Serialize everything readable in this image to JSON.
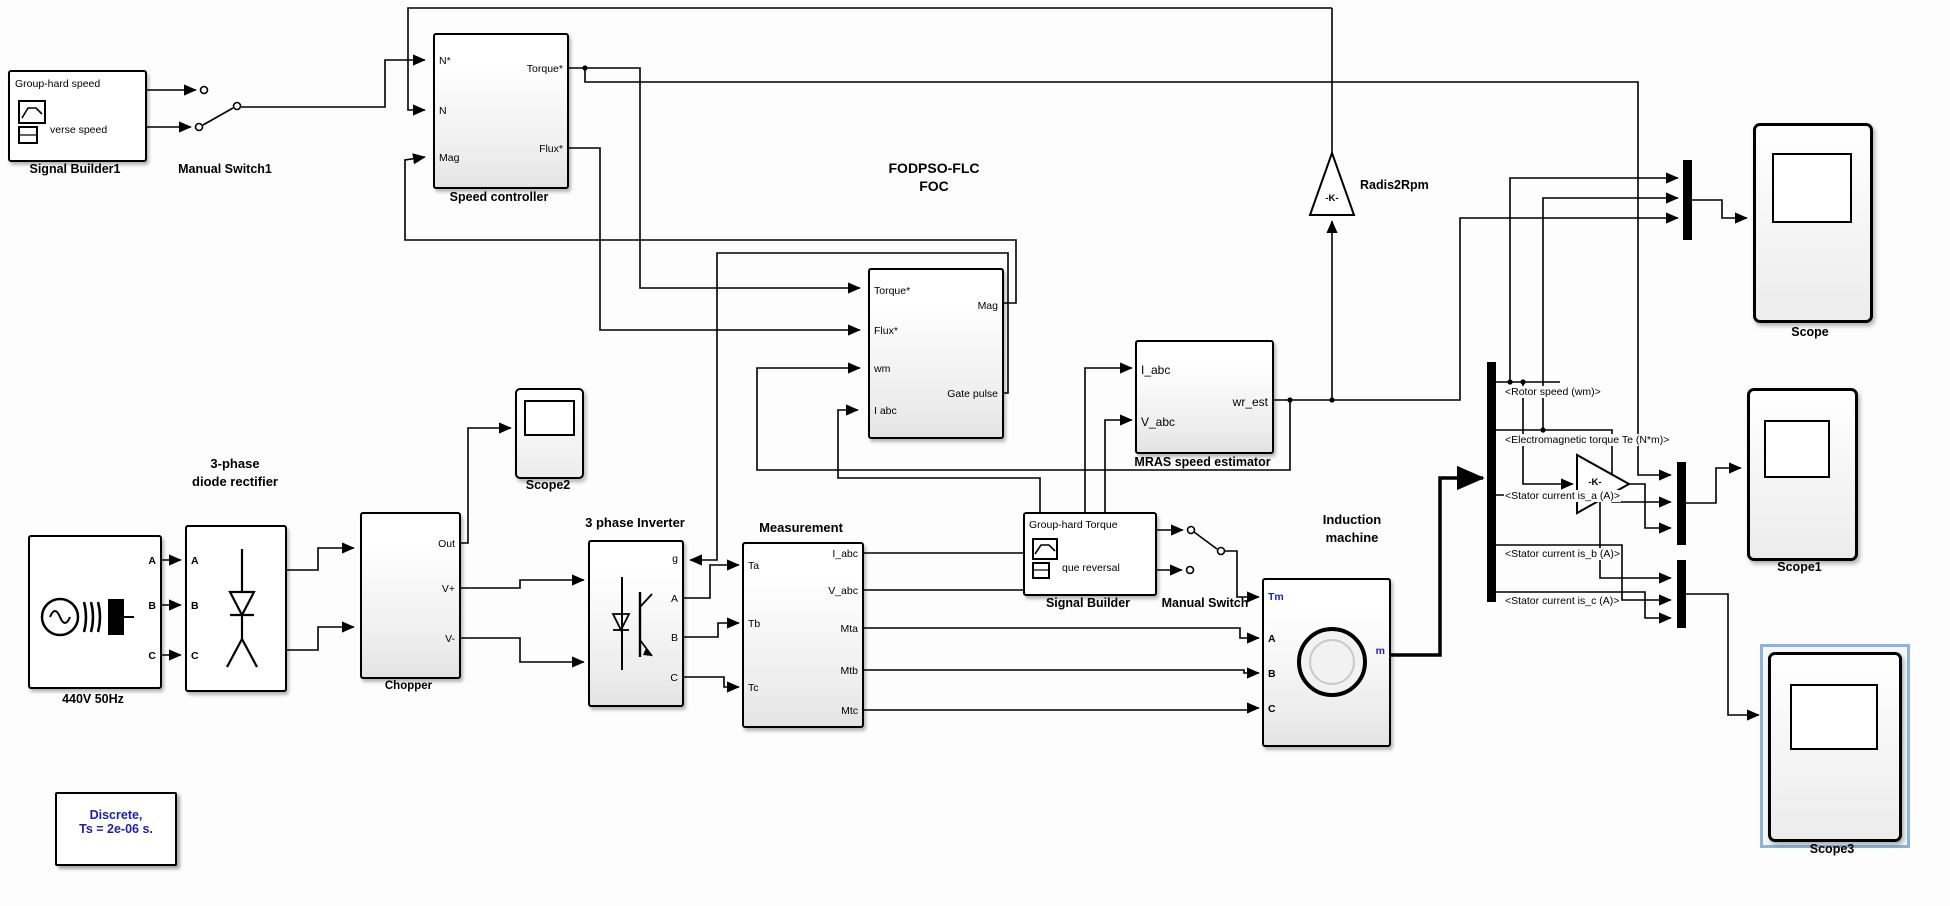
{
  "annotation": {
    "line1": "Discrete,",
    "line2": "Ts = 2e-06 s."
  },
  "signal_builder1": {
    "caption": "Signal Builder1",
    "sig_top": "Group-hard speed",
    "sig_bottom": "verse speed"
  },
  "manual_switch1": {
    "caption": "Manual Switch1"
  },
  "speed_controller": {
    "caption": "Speed controller",
    "in_n_ref": "N*",
    "in_n": "N",
    "in_mag": "Mag",
    "out_torque": "Torque*",
    "out_flux": "Flux*"
  },
  "foc": {
    "title1": "FODPSO-FLC",
    "title2": "FOC",
    "in_torque": "Torque*",
    "in_flux": "Flux*",
    "in_wm": "wm",
    "in_iabc": "I abc",
    "out_mag": "Mag",
    "out_gate": "Gate pulse"
  },
  "mras": {
    "caption": "MRAS speed estimator",
    "in_iabc": "I_abc",
    "in_vabc": "V_abc",
    "out_wrest": "wr_est"
  },
  "gain_rad2rpm": {
    "value": "-K-",
    "caption": "Radis2Rpm"
  },
  "scope": {
    "caption": "Scope"
  },
  "source": {
    "caption": "440V 50Hz",
    "port_a": "A",
    "port_b": "B",
    "port_c": "C"
  },
  "rectifier": {
    "caption1": "3-phase",
    "caption2": "diode rectifier",
    "port_a": "A",
    "port_b": "B",
    "port_c": "C"
  },
  "chopper": {
    "caption": "Chopper",
    "out": "Out",
    "vplus": "V+",
    "vminus": "V-"
  },
  "scope2": {
    "caption": "Scope2"
  },
  "inverter": {
    "caption": "3 phase Inverter",
    "port_g": "g",
    "port_a": "A",
    "port_b": "B",
    "port_c": "C"
  },
  "measurement": {
    "caption": "Measurement",
    "in_ta": "Ta",
    "in_tb": "Tb",
    "in_tc": "Tc",
    "out_iabc": "I_abc",
    "out_vabc": "V_abc",
    "out_mta": "Mta",
    "out_mtb": "Mtb",
    "out_mtc": "Mtc"
  },
  "signal_builder": {
    "caption": "Signal Builder",
    "sig_top": "Group-hard Torque",
    "sig_bottom": "que reversal"
  },
  "manual_switch": {
    "caption": "Manual Switch"
  },
  "induction_machine": {
    "caption1": "Induction",
    "caption2": "machine",
    "in_tm": "Tm",
    "in_a": "A",
    "in_b": "B",
    "in_c": "C",
    "out_m": "m"
  },
  "bus": {
    "sig1": "<Rotor speed (wm)>",
    "sig2": "<Electromagnetic torque Te (N*m)>",
    "sig3": "<Stator current is_a (A)>",
    "sig4": "<Stator current is_b (A)>",
    "sig5": "<Stator current is_c (A)>"
  },
  "gain_k": {
    "value": "-K-"
  },
  "scope1": {
    "caption": "Scope1"
  },
  "scope3": {
    "caption": "Scope3"
  },
  "colors": {
    "annotation_text": "#1f1fa8",
    "selection_frame": "#8fb3d6",
    "wire": "#000000"
  }
}
